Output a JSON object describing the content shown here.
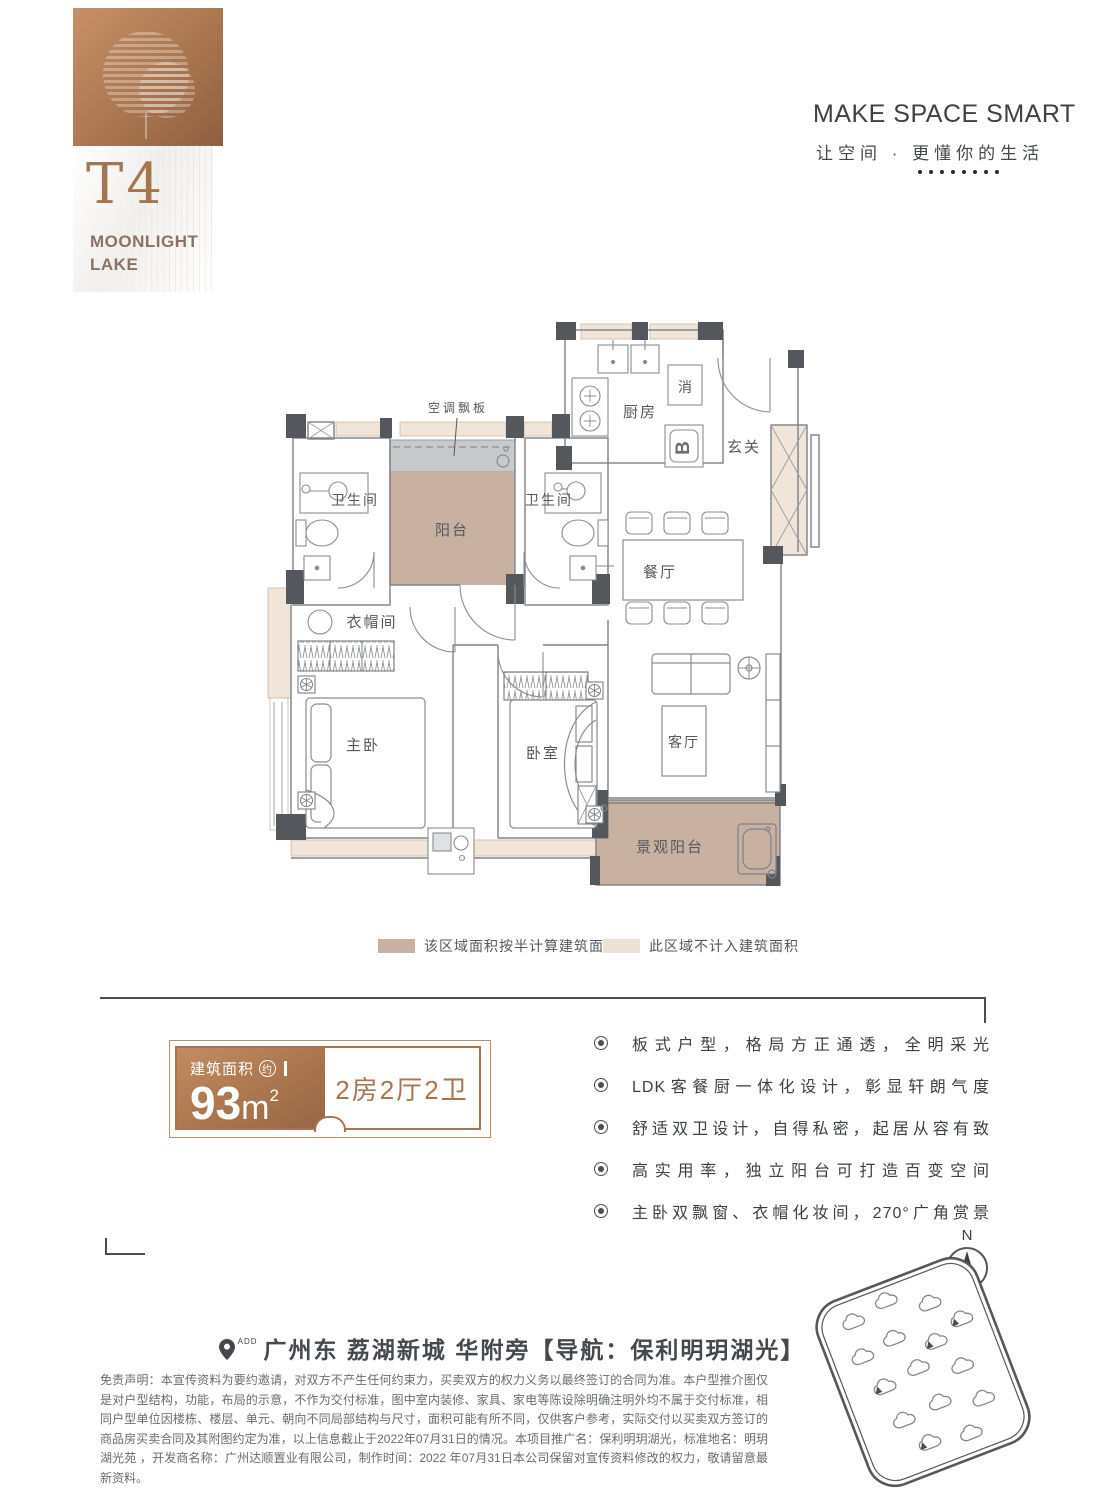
{
  "brand": {
    "unit_code": "T4",
    "name_line1": "MOONLIGHT",
    "name_line2": "LAKE",
    "slogan_en": "MAKE SPACE SMART",
    "slogan_cn": "让空间 · 更懂你的生活"
  },
  "floor_plan": {
    "annotation_ac_board": "空调飘板",
    "rooms": {
      "kitchen": "厨房",
      "foyer": "玄关",
      "bath_left": "卫生间",
      "bath_right": "卫生间",
      "balcony": "阳台",
      "dining": "餐厅",
      "cloakroom": "衣帽间",
      "master_bedroom": "主卧",
      "bedroom": "卧室",
      "living_room": "客厅",
      "view_balcony": "景观阳台"
    },
    "marks": {
      "extinguisher": "消",
      "fridge": "B"
    }
  },
  "legend": {
    "half_area": {
      "label": "该区域面积按半计算建筑面积",
      "color": "#c9b1a2"
    },
    "excluded_area": {
      "label": "此区域不计入建筑面积",
      "color": "#eee1d5"
    }
  },
  "spec": {
    "area_label": "建筑面积",
    "area_approx": "约",
    "area_value": "93",
    "area_unit": "m",
    "area_sup": "2",
    "layout": "2房2厅2卫"
  },
  "features": [
    "板式户型，格局方正通透，全明采光",
    "LDK客餐厨一体化设计，彰显轩朗气度",
    "舒适双卫设计，自得私密，起居从容有致",
    "高实用率，独立阳台可打造百变空间",
    "主卧双飘窗、衣帽化妆间，270°广角赏景"
  ],
  "address": {
    "pin_label": "ADD",
    "text": "广州东 荔湖新城 华附旁【导航：保利明玥湖光】"
  },
  "disclaimer": "免责声明：本宣传资料为要约邀请，对双方不产生任何约束力，买卖双方的权力义务以最终签订的合同为准。本户型推介图仅是对户型结构，功能，布局的示意，不作为交付标准，图中室内装修、家具、家电等陈设除明确注明外均不属于交付标准，相同户型单位因楼栋、楼层、单元、朝向不同局部结构与尺寸，面积可能有所不同，仅供客户参考，实际交付以买卖双方签订的商品房买卖合同及其附图约定为准，以上信息截止于2022年07月31日的情况。本项目推广名：保利明玥湖光，标准地名：明玥湖光苑 ，开发商名称：广州达顺置业有限公司，制作时间：2022 年07月31日本公司保留对宣传资料修改的权力，敬请留意最新资料。",
  "map": {
    "compass_label": "N"
  },
  "colors": {
    "bronze_dark": "#8f5f3f",
    "bronze": "#a9744f",
    "bronze_light": "#c79067",
    "wall_dark": "#54575b",
    "line_gray": "#7e8185",
    "tan_half": "#c9b1a2",
    "tan_light": "#f1e5d9",
    "ac_gray": "#c7c9cb",
    "text_dark": "#3c4044"
  }
}
